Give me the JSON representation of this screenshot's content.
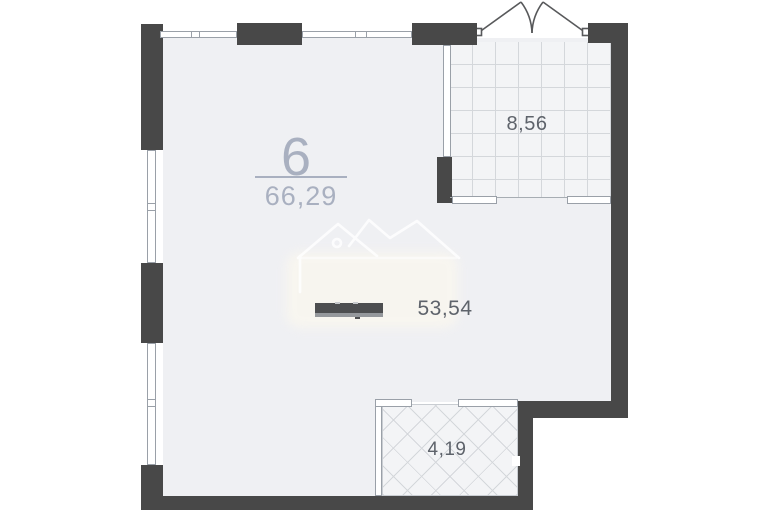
{
  "floor_plan": {
    "unit": {
      "number": "6",
      "total_area": "66,29"
    },
    "rooms": [
      {
        "id": "main-room",
        "area": "53,54"
      },
      {
        "id": "loggia-top-right",
        "area": "8,56"
      },
      {
        "id": "balcony-bottom",
        "area": "4,19"
      }
    ],
    "icons": {
      "watermark": "house-mountains-logo",
      "entry_doors": "double-swing-door",
      "kitchen_block": "counter-vent-block"
    },
    "colors": {
      "wall": "#484848",
      "room_fill": "#eff0f3",
      "tile_fill": "#f3f4f6",
      "grid_line": "#d4d7db",
      "area_label": "#5e636b",
      "unit_label": "#a9b0c0",
      "background": "#ffffff"
    }
  }
}
